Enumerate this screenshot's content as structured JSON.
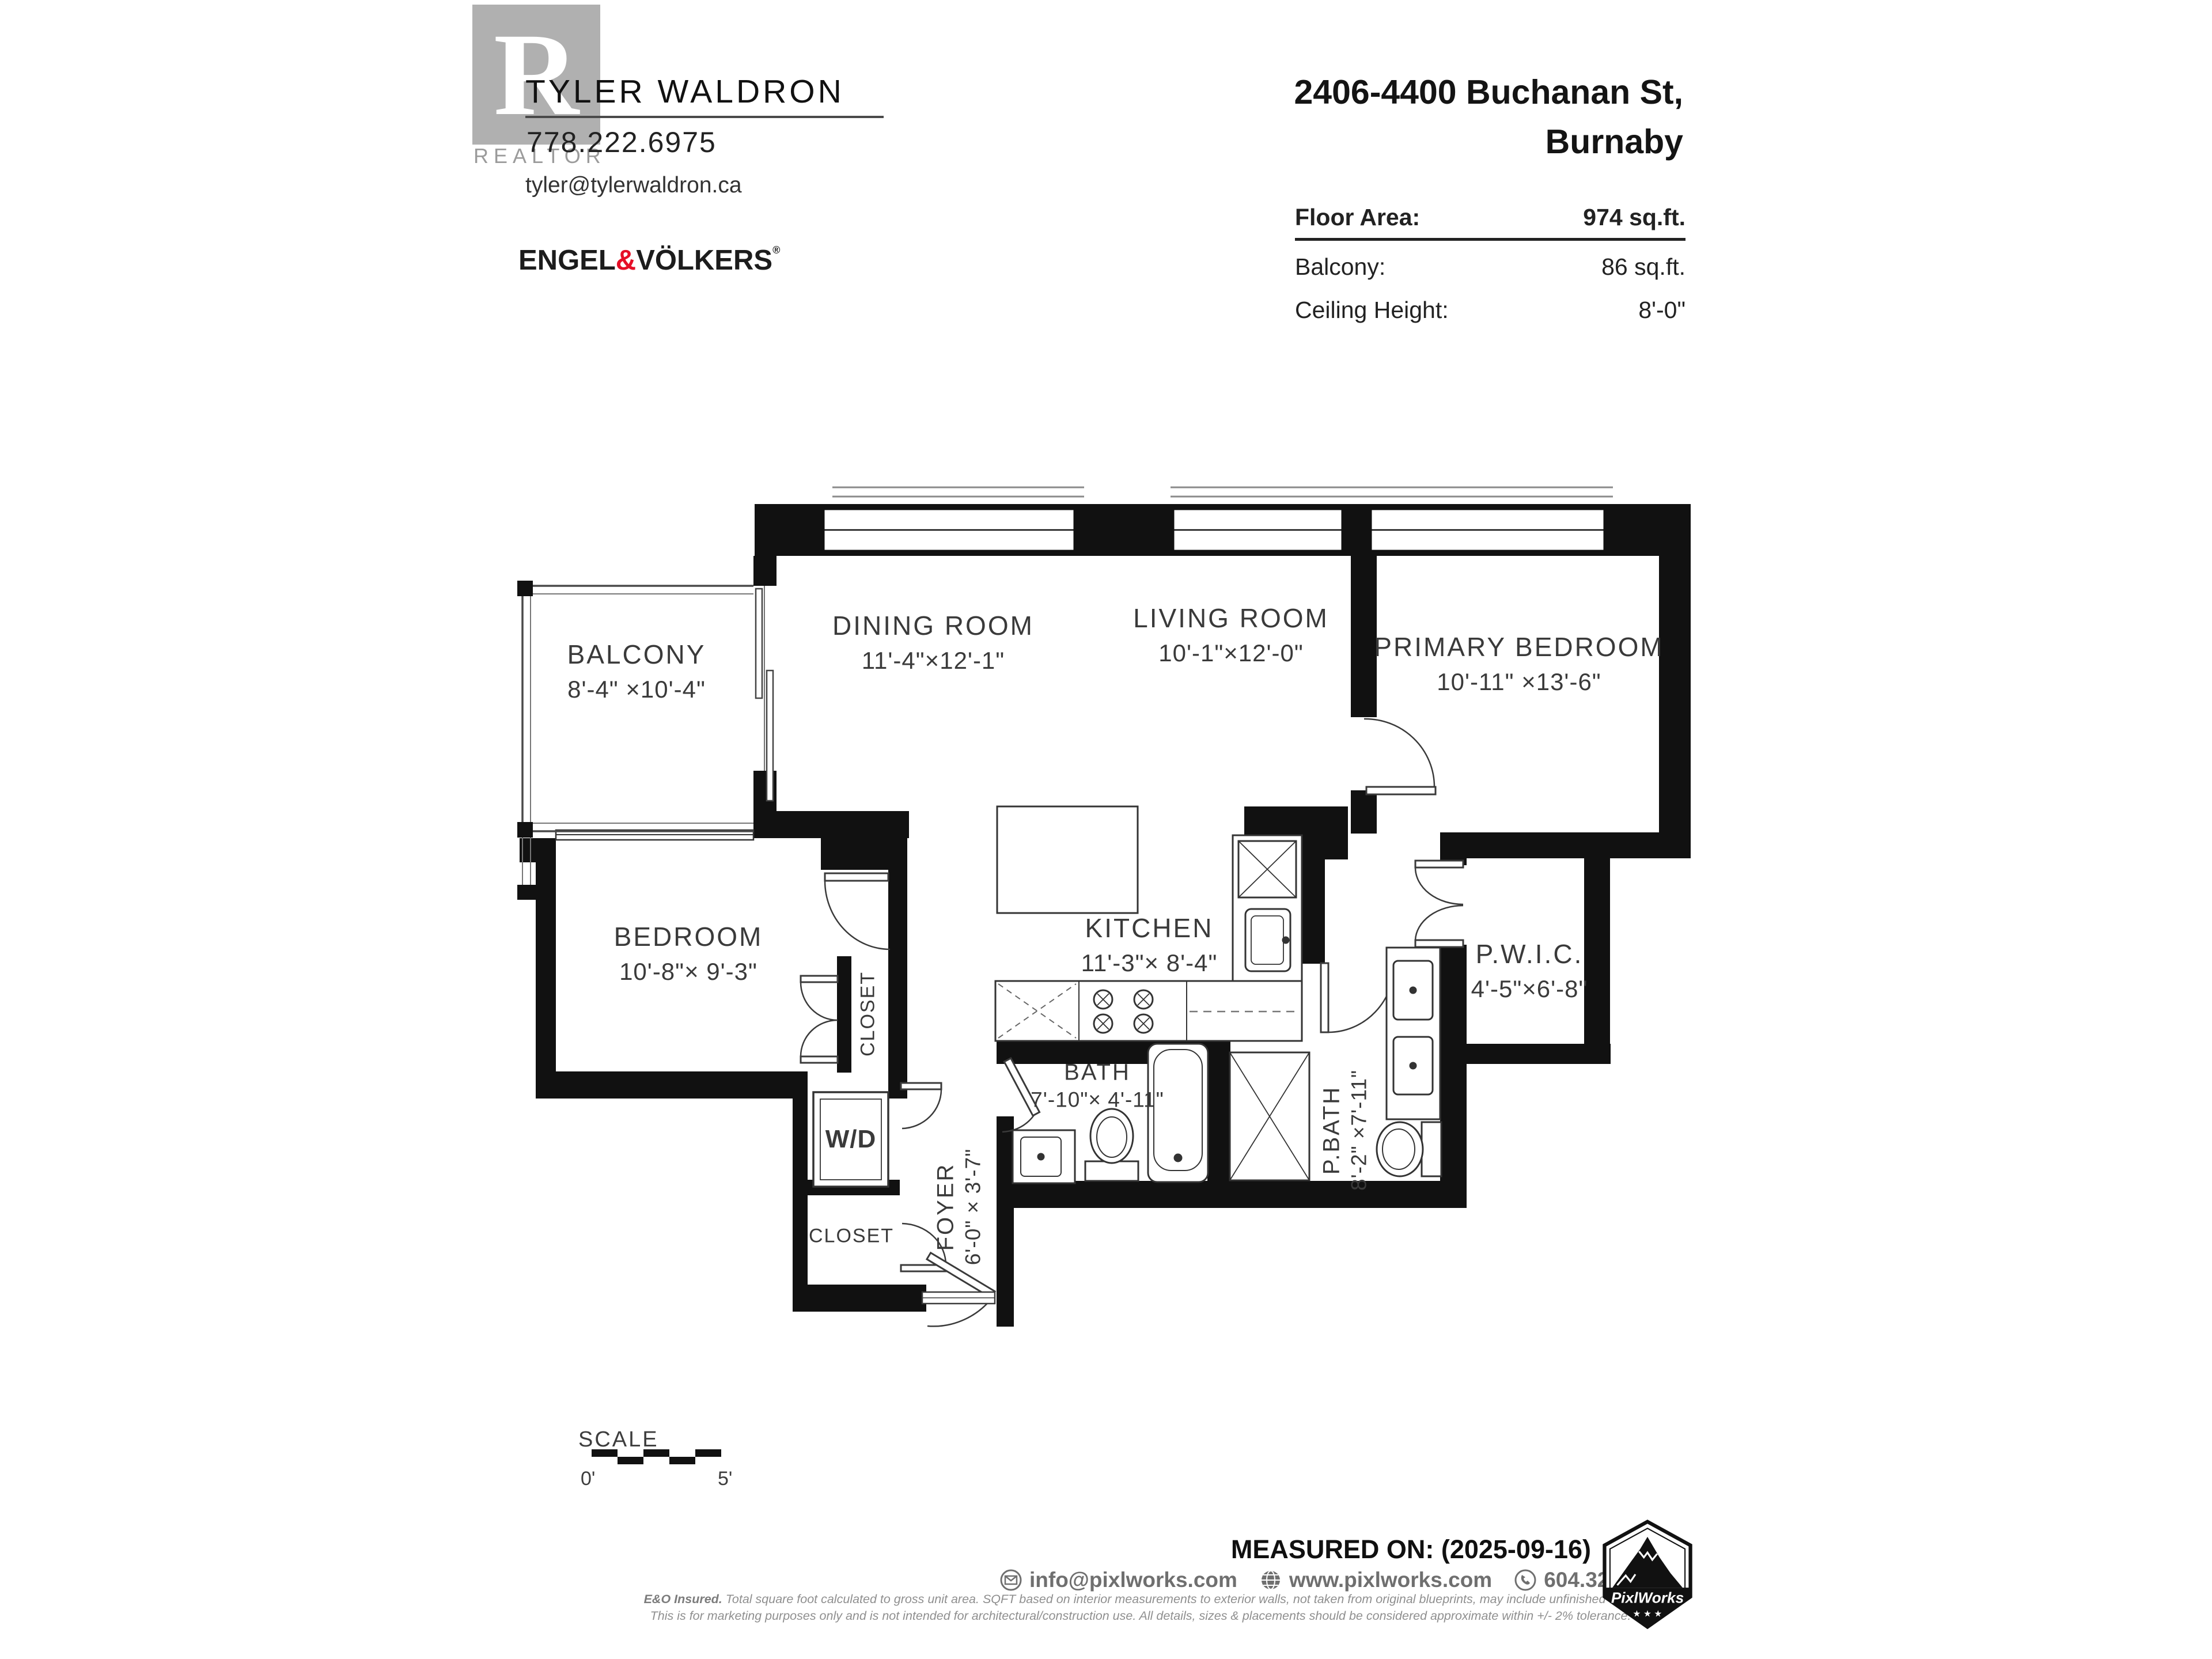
{
  "agent": {
    "logo_letter": "R",
    "logo_caption": "REALTOR",
    "name": "TYLER WALDRON",
    "phone": "778.222.6975",
    "email": "tyler@tylerwaldron.ca",
    "brokerage_part1": "ENGEL",
    "brokerage_amp": "&",
    "brokerage_part2": "VÖLKERS",
    "brokerage_reg": "®"
  },
  "property": {
    "address_line1": "2406-4400 Buchanan St,",
    "address_line2": "Burnaby",
    "stats": [
      {
        "label": "Floor Area:",
        "value": "974 sq.ft."
      },
      {
        "label": "Balcony:",
        "value": "86 sq.ft."
      },
      {
        "label": "Ceiling Height:",
        "value": "8'-0\""
      }
    ]
  },
  "plan": {
    "rooms": [
      {
        "name": "BALCONY",
        "dims": "8'-4\" ×10'-4\""
      },
      {
        "name": "DINING ROOM",
        "dims": "11'-4\"×12'-1\""
      },
      {
        "name": "LIVING ROOM",
        "dims": "10'-1\"×12'-0\""
      },
      {
        "name": "PRIMARY BEDROOM",
        "dims": "10'-11\" ×13'-6\""
      },
      {
        "name": "BEDROOM",
        "dims": "10'-8\"× 9'-3\""
      },
      {
        "name": "KITCHEN",
        "dims": "11'-3\"× 8'-4\""
      },
      {
        "name": "P.W.I.C.",
        "dims": "4'-5\"×6'-8\""
      },
      {
        "name": "BATH",
        "dims": "7'-10\"× 4'-11\""
      },
      {
        "name": "P.BATH",
        "dims": "8'-2\" ×7'-11\""
      },
      {
        "name": "CLOSET"
      },
      {
        "name": "CLOSET"
      },
      {
        "name": "FOYER",
        "dims": "6'-0\" × 3'-7\""
      },
      {
        "name": "W/D"
      }
    ],
    "scale": {
      "label": "SCALE",
      "start": "0'",
      "end": "5'"
    }
  },
  "footer": {
    "measured": "MEASURED ON: (2025-09-16)",
    "email": "info@pixlworks.com",
    "website": "www.pixlworks.com",
    "phone": "604.329.5788",
    "badge": "PixlWorks",
    "disclaimer1_label": "E&O Insured.",
    "disclaimer1_text": " Total square foot calculated to gross unit area. SQFT based on interior measurements to exterior walls, not taken from original blueprints, may include unfinished area.",
    "disclaimer2": "This is for marketing purposes only and is not intended for architectural/construction use.  All details, sizes & placements should be considered approximate within +/- 2%  tolerance."
  }
}
